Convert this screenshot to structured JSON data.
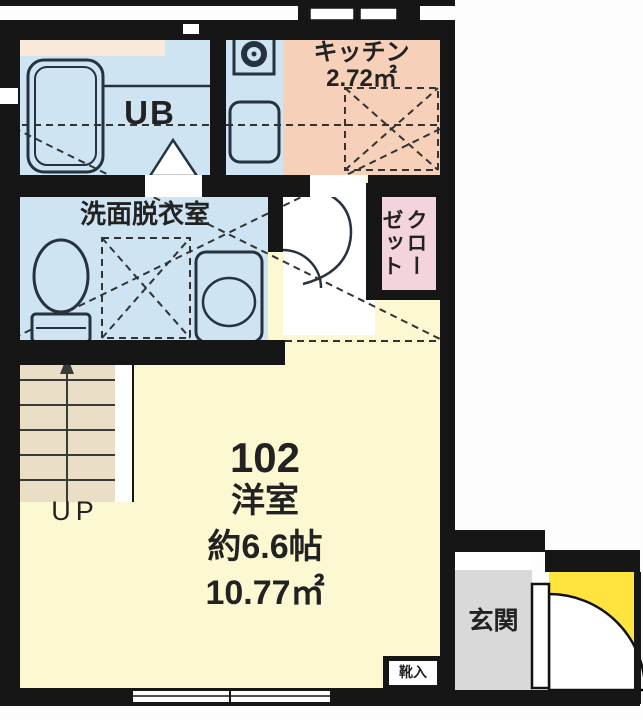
{
  "plan_title": "Unit 102 floor plan",
  "rooms": {
    "kitchen": {
      "label": "キッチン",
      "area": "2.72㎡"
    },
    "unit_bath": {
      "label": "UB"
    },
    "washroom": {
      "label": "洗面脱衣室"
    },
    "closet": {
      "label": "クローゼット",
      "col_right": "クロー",
      "col_left": "ゼット"
    },
    "main_room": {
      "number": "102",
      "type": "洋室",
      "size_jo": "約6.6帖",
      "area": "10.77㎡"
    },
    "stairs": {
      "label": "UP"
    },
    "entrance": {
      "label": "玄関"
    },
    "shoe_cabinet": {
      "label": "靴入"
    }
  },
  "colors": {
    "wall": "#161616",
    "wet_area_blue": "#cfe4f2",
    "kitchen_floor_pink": "#f6d0b8",
    "closet_pink": "#f4d4dc",
    "main_room_yellow": "#fcf8d2",
    "stairs_beige": "#eadfc6",
    "entrance_gray": "#d9d9d9",
    "exterior_door_yellow": "#ffe33e",
    "counter_cream": "#f9e9da"
  }
}
